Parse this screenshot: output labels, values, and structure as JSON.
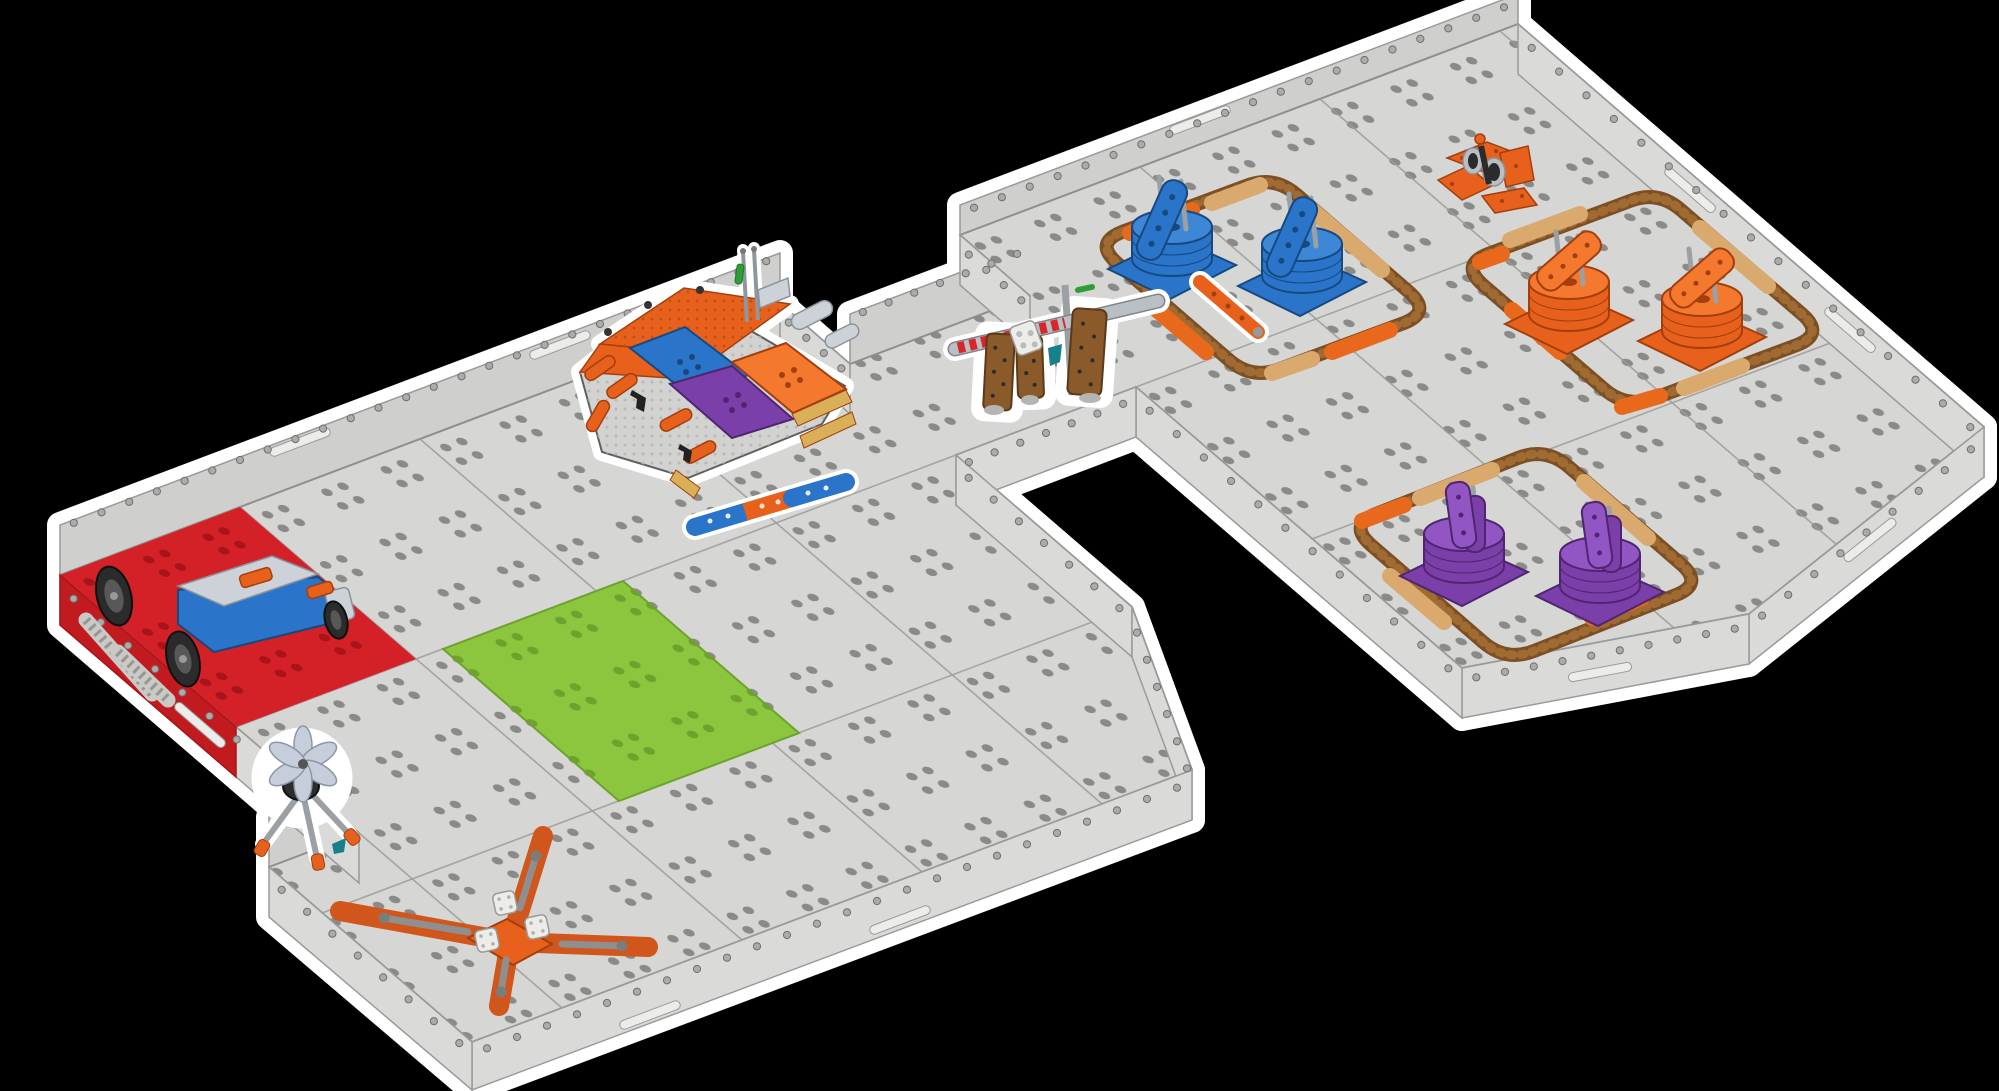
{
  "title": "Isometric render of a modular robotics competition field",
  "colors": {
    "background": "#000000",
    "floor": "#d6d6d4",
    "floor-line": "#8f8f8d",
    "floor-dot": "#8a8a88",
    "wall-far": "#cfcfcd",
    "wall-near": "#dadad8",
    "wall-line": "#9a9a98",
    "rivet": "#ababa9",
    "rivet-ring": "#6f6f6d",
    "seam": "#9b9b99",
    "slot": "#ececea",
    "red-platform": "#d42027",
    "red-dot": "#a8141a",
    "red-side": "#c11b20",
    "green-tile": "#8cc63e",
    "green-dot": "#6da32c",
    "ring-brown": "#7c4f24",
    "ring-link": "#a06a33",
    "ring-orange": "#e8681c",
    "ring-tan": "#d9a96e",
    "blue": "#2a74c9",
    "blue-light": "#3d87d6",
    "blue-dark": "#17497f",
    "orange": "#e8611c",
    "orange-light": "#f4782e",
    "orange-dark": "#a33f0e",
    "purple": "#7b3fa9",
    "purple-light": "#9156c4",
    "purple-dark": "#4f2570",
    "tan": "#d9b057",
    "brown-panel": "#8a5a2b",
    "brown-dark": "#5a3a18",
    "teal": "#17808a",
    "green-pin": "#2f9e36",
    "gray-metal": "#9aa0a4",
    "gray-light": "#ccd2d8",
    "steel": "#b9bfc2",
    "dark": "#2b2b2b",
    "white-part": "#ecece9",
    "part-line": "#8b929a",
    "fan": "#c6cedb",
    "hole": "#b5b5b3",
    "hole-orange": "#c24e12",
    "x-orange": "#d0561b",
    "tread": "#c9c9c7"
  },
  "field": {
    "zones": [
      {
        "name": "blue-zone",
        "color": "blue",
        "stack_count": 2
      },
      {
        "name": "orange-zone",
        "color": "orange",
        "stack_count": 2
      },
      {
        "name": "purple-zone",
        "color": "purple",
        "stack_count": 2
      }
    ],
    "stacks": [
      {
        "zone": "blue",
        "x": 1170,
        "y": 263
      },
      {
        "zone": "blue",
        "x": 1300,
        "y": 280
      },
      {
        "zone": "orange",
        "x": 1567,
        "y": 318
      },
      {
        "zone": "orange",
        "x": 1700,
        "y": 335
      },
      {
        "zone": "purple",
        "x": 1462,
        "y": 570
      },
      {
        "zone": "purple",
        "x": 1598,
        "y": 590
      }
    ],
    "elements": [
      "red-starting-platform",
      "practice-robot",
      "building-structure",
      "gate-bridge",
      "green-zone-tile",
      "x-divider",
      "pinwheel-stand",
      "winch-element"
    ]
  }
}
